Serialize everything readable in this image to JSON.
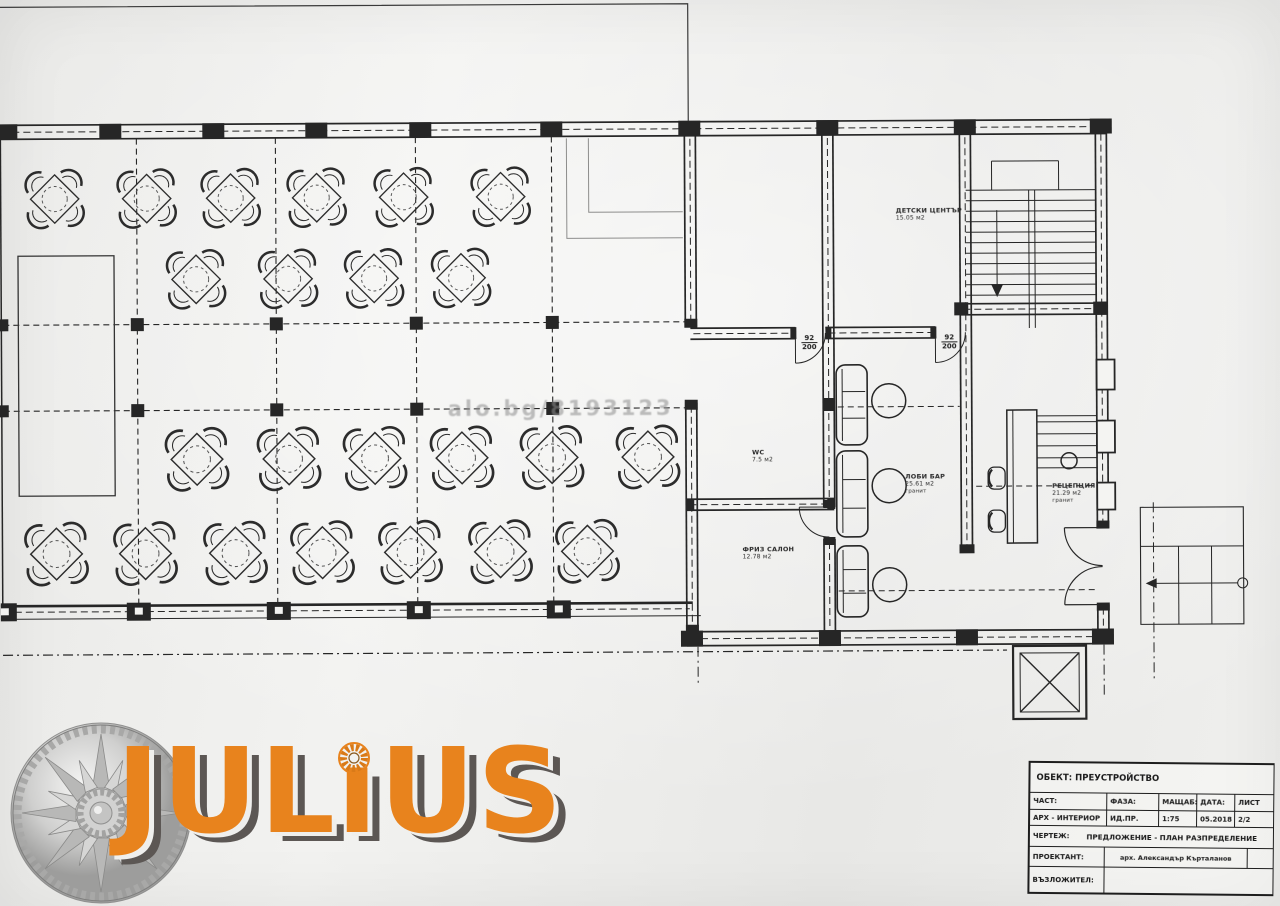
{
  "watermark": {
    "text": "alo.bg/8193123"
  },
  "plan": {
    "rooms": {
      "kids": {
        "name": "ДЕТСКИ ЦЕНТЪР",
        "area": "15.05 м2"
      },
      "wc": {
        "name": "WC",
        "area": "7.5 м2"
      },
      "salon": {
        "name": "ФРИЗ САЛОН",
        "area": "12.78 м2"
      },
      "bar": {
        "name": "ЛОБИ БАР",
        "area": "25.61 м2",
        "floor": "гранит"
      },
      "reception": {
        "name": "РЕЦЕПЦИЯ",
        "area": "21.29 м2",
        "floor": "гранит"
      }
    },
    "doors": {
      "d1": {
        "w": "92",
        "h": "200"
      },
      "d2": {
        "w": "92",
        "h": "200"
      }
    }
  },
  "logo": {
    "text": "JULiUS",
    "orange": "#E8831D",
    "shadow": "#5C5754"
  },
  "titleblock": {
    "object": "ОБЕКТ: ПРЕУСТРОЙСТВО",
    "headers": [
      "ЧАСТ:",
      "ФАЗА:",
      "МАЩАБ:",
      "ДАТА:",
      "ЛИСТ"
    ],
    "values": [
      "АРХ - ИНТЕРИОР",
      "ИД.ПР.",
      "1:75",
      "05.2018",
      "2/2"
    ],
    "drawing_label": "ЧЕРТЕЖ:",
    "drawing_value": "ПРЕДЛОЖЕНИЕ - ПЛАН РАЗПРЕДЕЛЕНИЕ",
    "designer_label": "ПРОЕКТАНТ:",
    "designer_value": "арх. Александър Кърталанов",
    "client_label": "ВЪЗЛОЖИТЕЛ:"
  },
  "colors": {
    "ink": "#262626",
    "paper": "#ECECEA",
    "logo_orange": "#E8831D",
    "logo_shadow": "#5C5754"
  }
}
